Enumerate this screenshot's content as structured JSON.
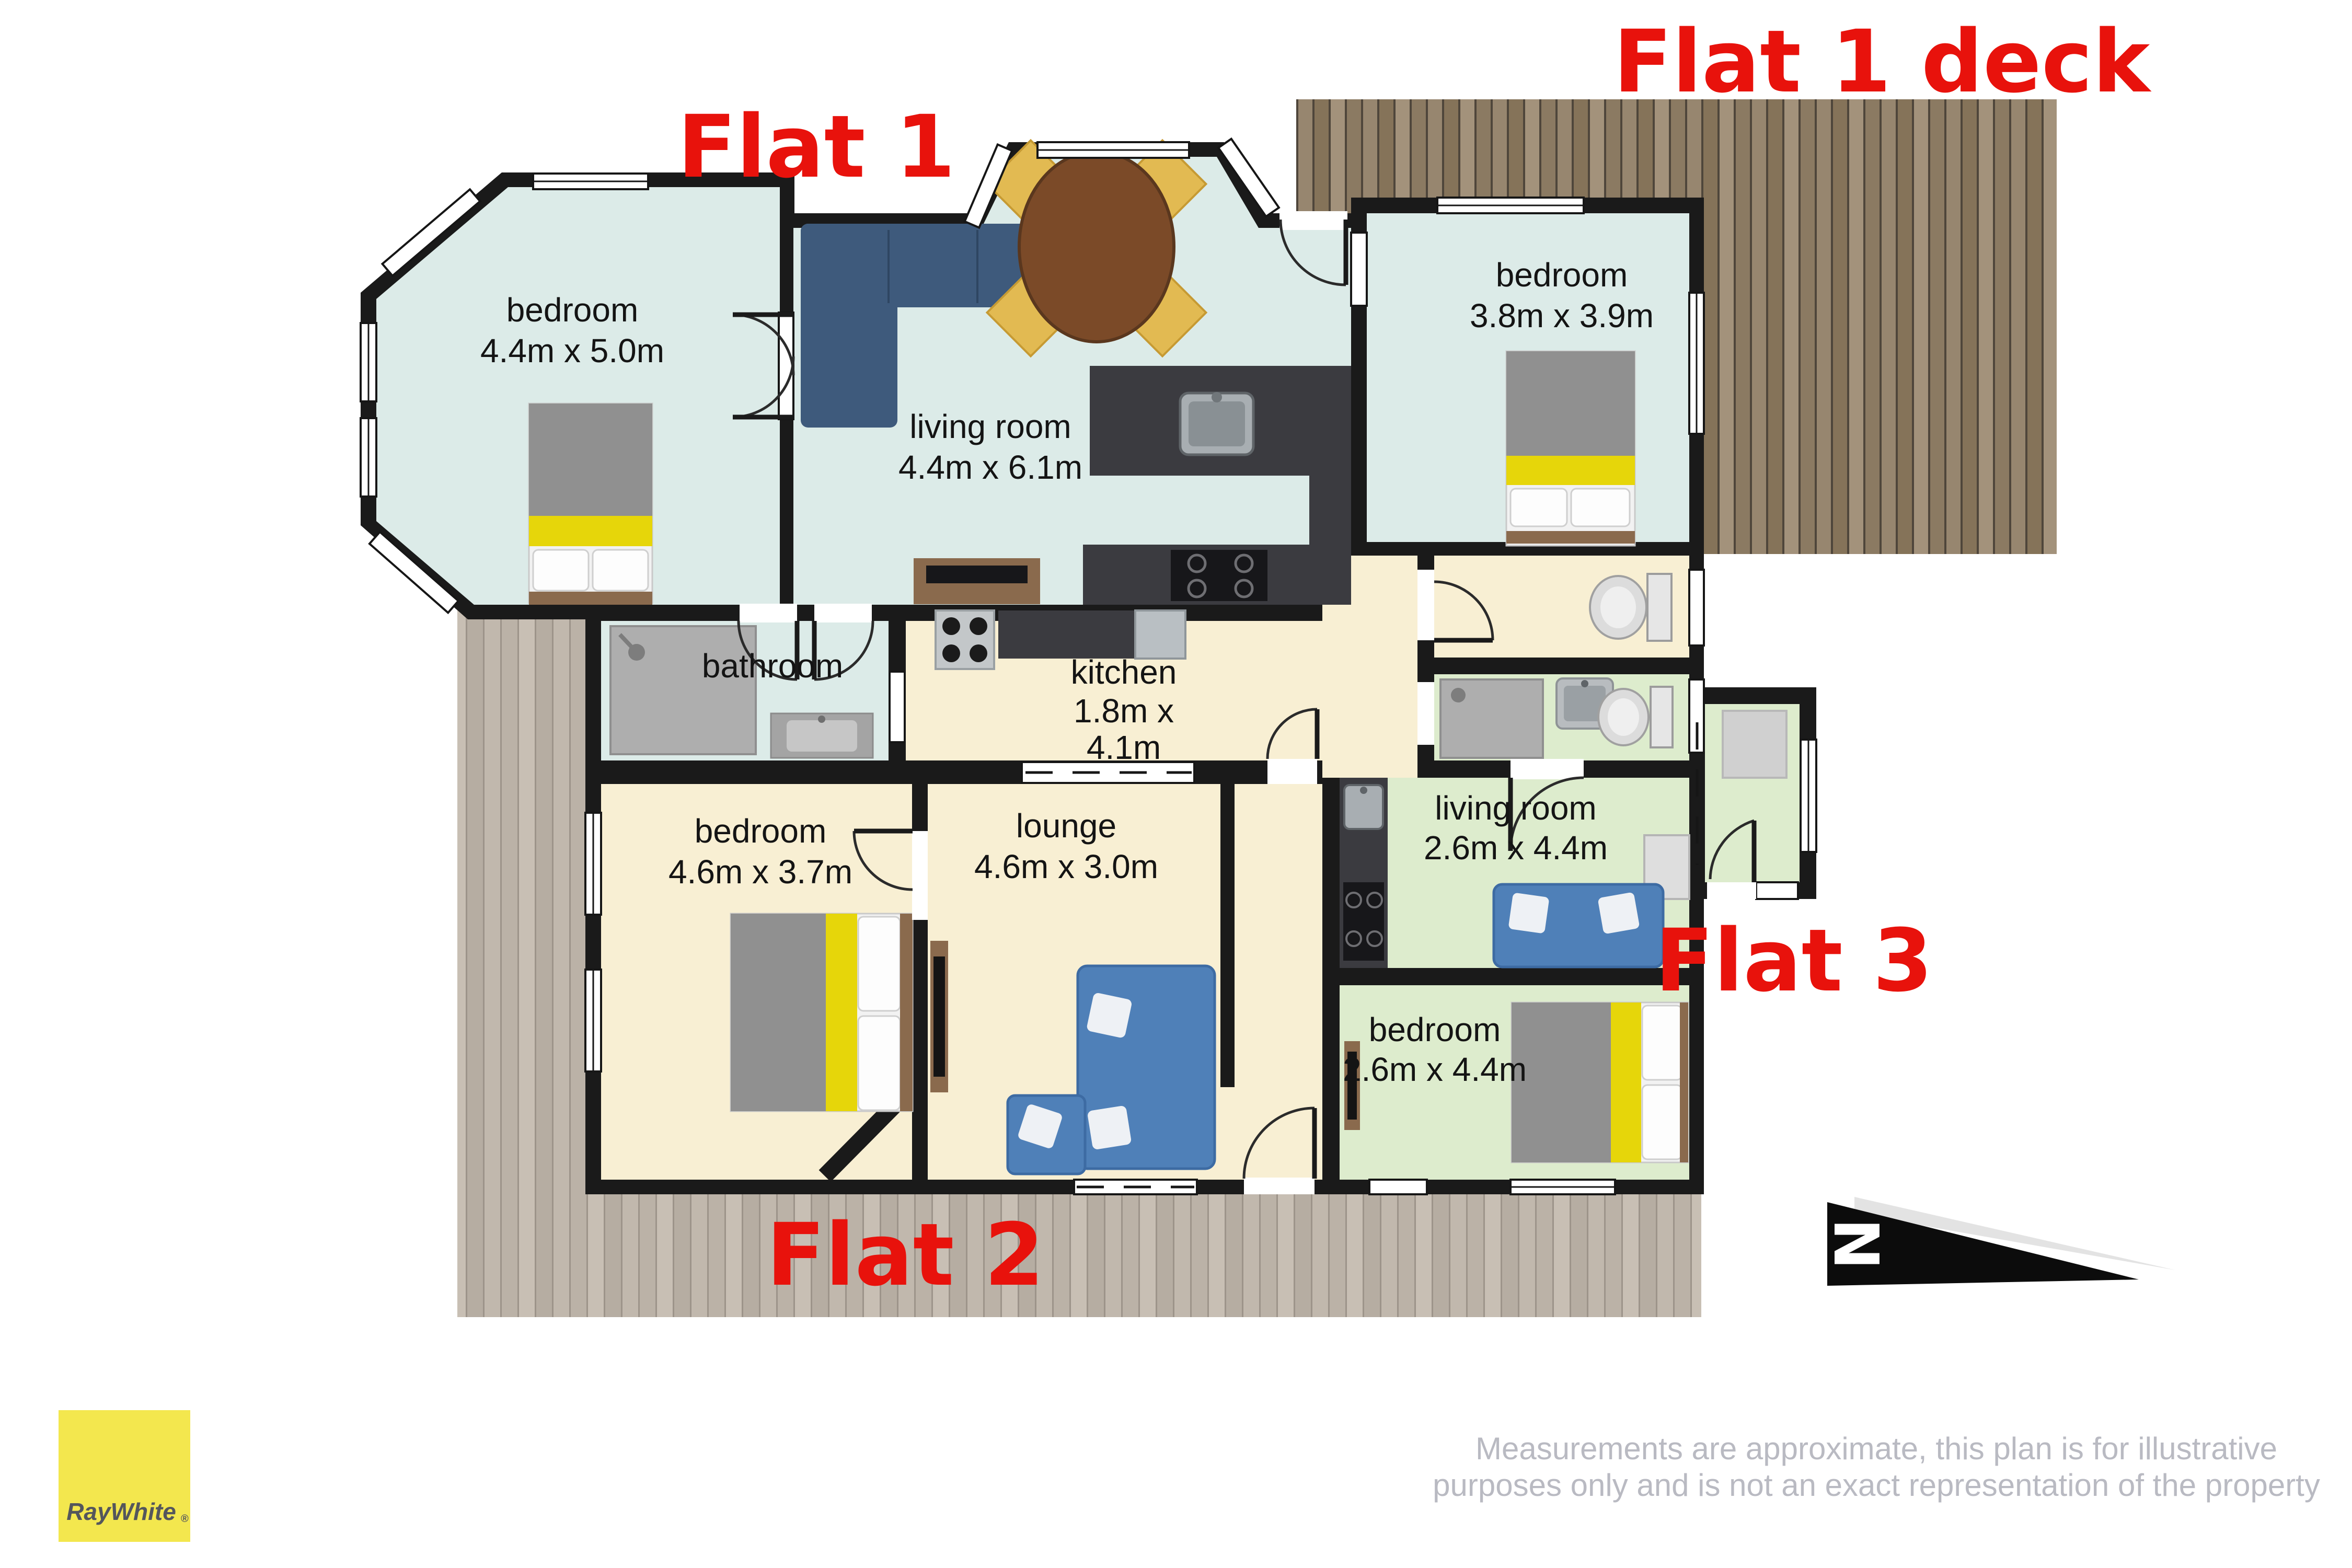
{
  "labels": {
    "flat1": "Flat 1",
    "flat1_deck": "Flat 1 deck",
    "flat2": "Flat 2",
    "flat3": "Flat 3"
  },
  "rooms": {
    "f1_bedroom1": {
      "name": "bedroom",
      "dims": "4.4m x 5.0m"
    },
    "f1_living": {
      "name": "living room",
      "dims": "4.4m x 6.1m"
    },
    "f1_bedroom2": {
      "name": "bedroom",
      "dims": "3.8m x 3.9m"
    },
    "f1_bathroom": {
      "name": "bathroom"
    },
    "f2_kitchen": {
      "name": "kitchen",
      "dims_line1": "1.8m x",
      "dims_line2": "4.1m"
    },
    "f2_bedroom": {
      "name": "bedroom",
      "dims": "4.6m x 3.7m"
    },
    "f2_lounge": {
      "name": "lounge",
      "dims": "4.6m x 3.0m"
    },
    "f3_living": {
      "name": "living room",
      "dims": "2.6m x 4.4m"
    },
    "f3_bedroom": {
      "name": "bedroom",
      "dims": "2.6m x 4.4m"
    }
  },
  "compass": {
    "north_letter": "N"
  },
  "branding": {
    "logo_text": "RayWhite",
    "registered_mark": "®"
  },
  "disclaimer": {
    "line1": "Measurements are approximate, this plan is for illustrative",
    "line2": "purposes only and is not an exact representation of the property"
  },
  "colors": {
    "flat1_floor": "#dcebe8",
    "flat2_floor": "#f8efd3",
    "flat3_floor": "#ddeccd",
    "wall": "#1a1a1a",
    "flat_label_red": "#e8120c",
    "deck_wood_brown": "#8e7e69",
    "deck_wood_grey": "#b4aba0",
    "logo_yellow": "#f3e74e",
    "logo_text_grey": "#54565c",
    "disclaimer_grey": "#b9bac2",
    "bed_yellow": "#e6d60a",
    "sofa_navy": "#3e5a7c",
    "sofa_blue": "#4f80b8",
    "counter_dark": "#3b3b40"
  }
}
